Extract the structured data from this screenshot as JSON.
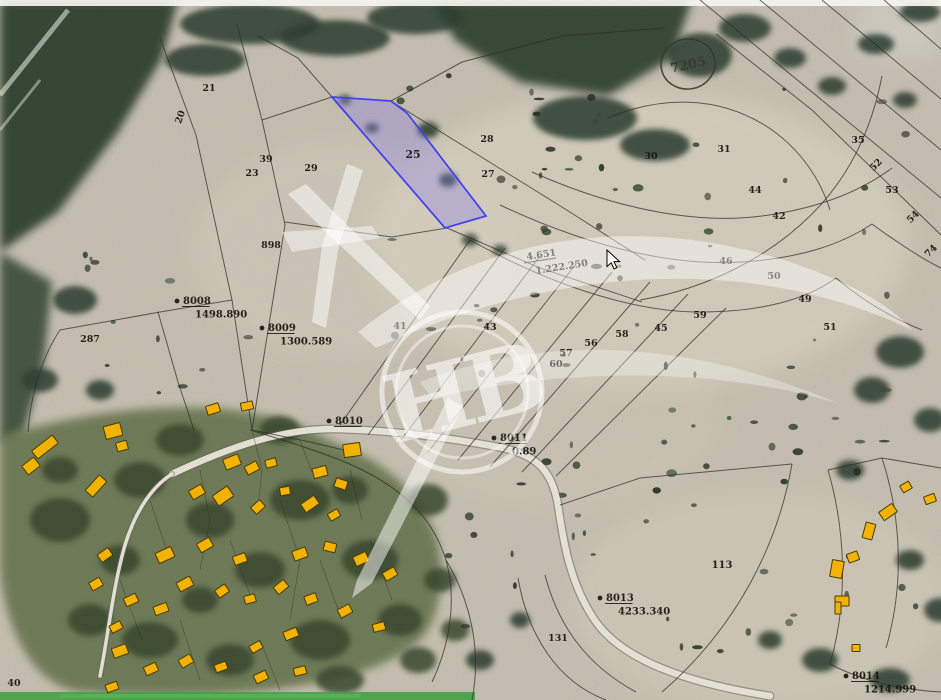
{
  "map": {
    "colors": {
      "terrain": "#c7c0b1",
      "forest": "#2e402e",
      "village_green": "#5a6a42",
      "line": "#2e2c26",
      "road": "#e9e5d9",
      "road_edge": "#5f5f55",
      "building_fill": "#f2b300",
      "building_stroke": "#4a3a06",
      "highlight_fill": "#8a7fe8",
      "highlight_stroke": "#4444ee",
      "label": "#17140f",
      "watermark": "#ffffff",
      "green_strip": "#46a046"
    },
    "highlight": {
      "label": "25",
      "points": [
        [
          332,
          97
        ],
        [
          391,
          101
        ],
        [
          407,
          113
        ],
        [
          486,
          216
        ],
        [
          445,
          228
        ]
      ]
    },
    "labels": [
      {
        "t": "20",
        "x": 183,
        "y": 118,
        "r": -70
      },
      {
        "t": "21",
        "x": 209,
        "y": 91,
        "r": 0
      },
      {
        "t": "39",
        "x": 266,
        "y": 162,
        "r": 0
      },
      {
        "t": "23",
        "x": 252,
        "y": 176,
        "r": 0
      },
      {
        "t": "29",
        "x": 311,
        "y": 171,
        "r": 0
      },
      {
        "t": "898",
        "x": 271,
        "y": 248,
        "r": 0
      },
      {
        "t": "287",
        "x": 90,
        "y": 342,
        "r": 0
      },
      {
        "t": "25",
        "x": 413,
        "y": 158,
        "r": 0,
        "s": 11
      },
      {
        "t": "27",
        "x": 488,
        "y": 177,
        "r": 0
      },
      {
        "t": "28",
        "x": 487,
        "y": 142,
        "r": 0
      },
      {
        "t": "30",
        "x": 651,
        "y": 159,
        "r": 0
      },
      {
        "t": "31",
        "x": 724,
        "y": 152,
        "r": 0
      },
      {
        "t": "35",
        "x": 858,
        "y": 143,
        "r": 0
      },
      {
        "t": "52",
        "x": 878,
        "y": 167,
        "r": -45
      },
      {
        "t": "53",
        "x": 892,
        "y": 193,
        "r": 0
      },
      {
        "t": "54",
        "x": 915,
        "y": 219,
        "r": -45
      },
      {
        "t": "74",
        "x": 933,
        "y": 253,
        "r": -45
      },
      {
        "t": "44",
        "x": 755,
        "y": 193,
        "r": 0
      },
      {
        "t": "42",
        "x": 779,
        "y": 219,
        "r": 0
      },
      {
        "t": "46",
        "x": 726,
        "y": 264,
        "r": 0
      },
      {
        "t": "50",
        "x": 774,
        "y": 279,
        "r": 0
      },
      {
        "t": "49",
        "x": 805,
        "y": 302,
        "r": 0
      },
      {
        "t": "51",
        "x": 830,
        "y": 330,
        "r": 0
      },
      {
        "t": "59",
        "x": 700,
        "y": 318,
        "r": 0
      },
      {
        "t": "45",
        "x": 661,
        "y": 331,
        "r": 0
      },
      {
        "t": "58",
        "x": 622,
        "y": 337,
        "r": 0
      },
      {
        "t": "56",
        "x": 591,
        "y": 346,
        "r": 0
      },
      {
        "t": "57",
        "x": 566,
        "y": 356,
        "r": 0
      },
      {
        "t": "60",
        "x": 556,
        "y": 367,
        "r": 0
      },
      {
        "t": "41",
        "x": 400,
        "y": 329,
        "r": 0
      },
      {
        "t": "43",
        "x": 490,
        "y": 330,
        "r": 0
      },
      {
        "t": "113",
        "x": 722,
        "y": 568,
        "r": 0,
        "s": 10
      },
      {
        "t": "131",
        "x": 558,
        "y": 641,
        "r": 0
      },
      {
        "t": "40",
        "x": 14,
        "y": 686,
        "r": 0
      }
    ],
    "markers": [
      {
        "id": "8008",
        "value": "1498.890",
        "x": 183,
        "y": 304
      },
      {
        "id": "8009",
        "value": "1300.589",
        "x": 268,
        "y": 331
      },
      {
        "id": "8010",
        "value": "",
        "x": 335,
        "y": 424
      },
      {
        "id": "8011",
        "value": "0.89",
        "x": 500,
        "y": 441
      },
      {
        "id": "8013",
        "value": "4233.340",
        "x": 606,
        "y": 601
      },
      {
        "id": "8014",
        "value": "1214.999",
        "x": 852,
        "y": 679
      }
    ],
    "area_note": {
      "l1": "4.651",
      "l2": "1.222.250",
      "x": 527,
      "y": 260,
      "r": -9
    },
    "seal": {
      "t": "7205",
      "x": 688,
      "y": 64
    },
    "watermark_text": "НВ",
    "roads": [
      {
        "d": "M172,474 C240,442 290,428 338,429 C405,431 460,440 498,447 C536,454 552,470 558,505 C563,540 570,585 596,622 C622,658 680,682 770,696",
        "w": 6.5
      },
      {
        "d": "M172,474 C150,488 132,516 122,556 C112,596 108,636 100,676",
        "w": 3.5
      }
    ],
    "lines": [
      {
        "d": "M160,38 L196,135 L232,300 L252,430"
      },
      {
        "d": "M237,24 L262,120 L285,225 L252,430"
      },
      {
        "d": "M262,120 L332,97"
      },
      {
        "d": "M285,222 L392,237 L447,228"
      },
      {
        "d": "M332,97 L298,58 L258,36"
      },
      {
        "d": "M391,101 L462,62 L562,36 L664,28"
      },
      {
        "d": "M391,101 L470,150 L562,207 L645,260"
      },
      {
        "d": "M447,228 L540,268 L642,302"
      },
      {
        "d": "M252,430 L310,442 L352,452"
      },
      {
        "d": "M250,430 C300,445 332,456 354,466 C402,488 432,516 446,560 C456,596 452,640 432,682"
      },
      {
        "d": "M340,425 L470,240"
      },
      {
        "d": "M368,435 L505,248"
      },
      {
        "d": "M398,444 L540,256"
      },
      {
        "d": "M428,452 L576,264"
      },
      {
        "d": "M458,460 L612,272"
      },
      {
        "d": "M490,467 L650,282"
      },
      {
        "d": "M522,472 L688,294"
      },
      {
        "d": "M556,476 L726,308"
      },
      {
        "d": "M470,240 C560,290 640,312 700,312 C760,312 806,300 836,278"
      },
      {
        "d": "M500,205 C600,252 682,266 742,262 C802,258 842,244 872,224"
      },
      {
        "d": "M532,172 C622,212 702,224 762,216 C822,208 862,190 892,168"
      },
      {
        "d": "M700,0 L941,198"
      },
      {
        "d": "M760,0 L941,150"
      },
      {
        "d": "M822,0 L941,99"
      },
      {
        "d": "M884,0 L941,49"
      },
      {
        "d": "M941,235 L812,110 L716,34"
      },
      {
        "d": "M640,300 C710,288 770,256 812,214 C850,176 872,128 882,76"
      },
      {
        "d": "M836,278 C862,300 892,318 922,330"
      },
      {
        "d": "M872,224 C902,246 928,262 941,268"
      },
      {
        "d": "M560,505 L640,478 L792,464"
      },
      {
        "d": "M792,464 C778,544 738,626 662,692"
      },
      {
        "d": "M828,470 C846,532 848,602 830,664"
      },
      {
        "d": "M545,575 C558,625 586,665 636,692"
      },
      {
        "d": "M518,578 C528,636 558,682 606,700"
      },
      {
        "d": "M446,560 C470,600 482,650 472,700"
      },
      {
        "d": "M60,330 L160,312 L232,300"
      },
      {
        "d": "M60,330 C40,360 30,400 28,432"
      },
      {
        "d": "M158,312 L178,382 L194,430"
      },
      {
        "d": "M608,118 C660,96 720,94 772,130 C800,150 820,178 830,210"
      },
      {
        "d": "M828,470 L882,458 L941,468"
      },
      {
        "d": "M882,458 C902,520 904,586 886,648"
      },
      {
        "d": "M830,664 C860,680 900,690 941,692"
      },
      {
        "d": "M252,430 L262,470 L258,508",
        "w": 0.7,
        "o": 0.5
      },
      {
        "d": "M300,440 L312,472",
        "w": 0.7,
        "o": 0.5
      },
      {
        "d": "M200,470 L210,520 L200,570",
        "w": 0.7,
        "o": 0.5
      },
      {
        "d": "M280,500 L300,560 L290,620",
        "w": 0.7,
        "o": 0.5
      },
      {
        "d": "M350,470 L362,520",
        "w": 0.7,
        "o": 0.5
      },
      {
        "d": "M150,500 L170,560",
        "w": 0.7,
        "o": 0.5
      },
      {
        "d": "M230,540 L252,600",
        "w": 0.7,
        "o": 0.5
      },
      {
        "d": "M320,560 L342,620",
        "w": 0.7,
        "o": 0.5
      },
      {
        "d": "M370,540 L392,600",
        "w": 0.7,
        "o": 0.5
      },
      {
        "d": "M260,640 L280,690",
        "w": 0.7,
        "o": 0.5
      },
      {
        "d": "M180,620 L200,680",
        "w": 0.7,
        "o": 0.5
      },
      {
        "d": "M120,580 L142,640",
        "w": 0.7,
        "o": 0.5
      }
    ],
    "buildings": [
      [
        45,
        447,
        26,
        10,
        -38
      ],
      [
        31,
        466,
        15,
        11,
        -38
      ],
      [
        113,
        431,
        17,
        13,
        -15
      ],
      [
        122,
        446,
        11,
        9,
        -15
      ],
      [
        96,
        486,
        21,
        10,
        -48
      ],
      [
        213,
        409,
        13,
        9,
        -18
      ],
      [
        247,
        406,
        12,
        8,
        -12
      ],
      [
        232,
        462,
        16,
        11,
        -22
      ],
      [
        252,
        468,
        13,
        9,
        -28
      ],
      [
        271,
        463,
        11,
        8,
        -15
      ],
      [
        197,
        492,
        14,
        10,
        -30
      ],
      [
        223,
        496,
        18,
        12,
        -35
      ],
      [
        258,
        507,
        12,
        9,
        -42
      ],
      [
        285,
        491,
        10,
        8,
        -10
      ],
      [
        320,
        472,
        14,
        10,
        -15
      ],
      [
        341,
        484,
        12,
        9,
        18
      ],
      [
        310,
        504,
        16,
        10,
        -35
      ],
      [
        334,
        515,
        11,
        8,
        -30
      ],
      [
        352,
        450,
        17,
        13,
        -8
      ],
      [
        165,
        555,
        17,
        11,
        -25
      ],
      [
        205,
        545,
        14,
        10,
        -30
      ],
      [
        240,
        559,
        13,
        9,
        -20
      ],
      [
        185,
        584,
        15,
        10,
        -28
      ],
      [
        222,
        591,
        12,
        9,
        -35
      ],
      [
        161,
        609,
        14,
        9,
        -20
      ],
      [
        250,
        599,
        11,
        8,
        -15
      ],
      [
        281,
        587,
        13,
        9,
        -40
      ],
      [
        300,
        554,
        14,
        10,
        -20
      ],
      [
        330,
        547,
        12,
        9,
        15
      ],
      [
        361,
        559,
        14,
        10,
        -25
      ],
      [
        390,
        574,
        13,
        9,
        -30
      ],
      [
        311,
        599,
        12,
        9,
        -20
      ],
      [
        345,
        611,
        13,
        9,
        -28
      ],
      [
        379,
        627,
        12,
        8,
        -15
      ],
      [
        291,
        634,
        14,
        9,
        -22
      ],
      [
        256,
        647,
        12,
        8,
        -30
      ],
      [
        120,
        651,
        15,
        10,
        -20
      ],
      [
        151,
        669,
        13,
        9,
        -25
      ],
      [
        186,
        661,
        13,
        9,
        -30
      ],
      [
        221,
        667,
        12,
        8,
        -20
      ],
      [
        261,
        677,
        13,
        9,
        -25
      ],
      [
        300,
        671,
        12,
        8,
        -15
      ],
      [
        112,
        687,
        12,
        8,
        -20
      ],
      [
        105,
        555,
        13,
        9,
        -35
      ],
      [
        96,
        584,
        12,
        9,
        -30
      ],
      [
        131,
        600,
        13,
        9,
        -25
      ],
      [
        116,
        627,
        12,
        8,
        -28
      ],
      [
        888,
        512,
        16,
        10,
        -35
      ],
      [
        869,
        531,
        10,
        16,
        15
      ],
      [
        853,
        557,
        11,
        9,
        -20
      ],
      [
        837,
        569,
        12,
        17,
        10
      ],
      [
        842,
        601,
        14,
        10,
        0
      ],
      [
        838,
        608,
        6,
        12,
        0
      ],
      [
        856,
        648,
        8,
        7,
        0
      ],
      [
        930,
        499,
        11,
        8,
        -20
      ],
      [
        906,
        487,
        10,
        8,
        -30
      ]
    ]
  }
}
